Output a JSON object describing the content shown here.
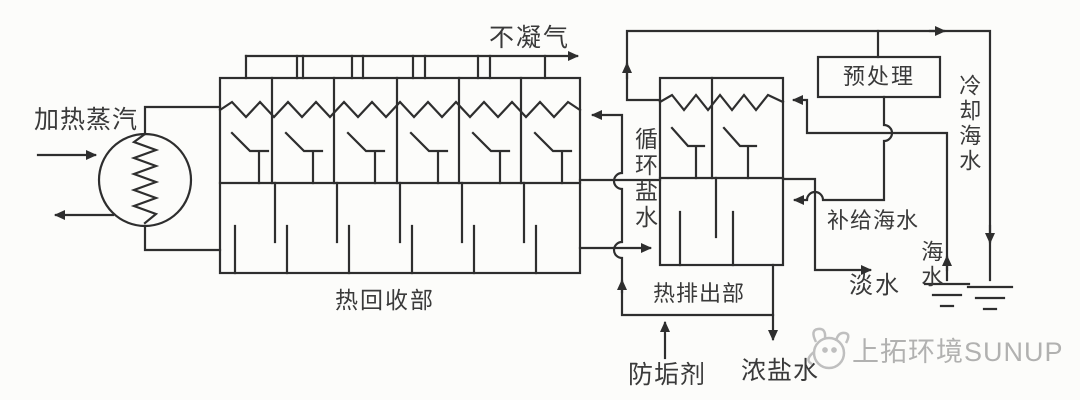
{
  "diagram_title_implicit": "多级闪蒸海水淡化流程图",
  "colors": {
    "line": "#2e2e2e",
    "text": "#3a3a3a",
    "background": "#fcfcfa",
    "watermark": "#a9a9a9"
  },
  "labels": {
    "heating_steam": "加热蒸汽",
    "non_condensable_gas": "不凝气",
    "heat_recovery_section": "热回收部",
    "heat_rejection_section": "热排出部",
    "circulating_brine": "循环盐水",
    "anti_scalant": "防垢剂",
    "concentrated_brine": "浓盐水",
    "fresh_water": "淡水",
    "makeup_seawater": "补给海水",
    "seawater": "海水",
    "pretreatment": "预处理",
    "cooling_seawater": "冷却海水"
  },
  "watermark": {
    "text": "上拓环境SUNUP"
  }
}
